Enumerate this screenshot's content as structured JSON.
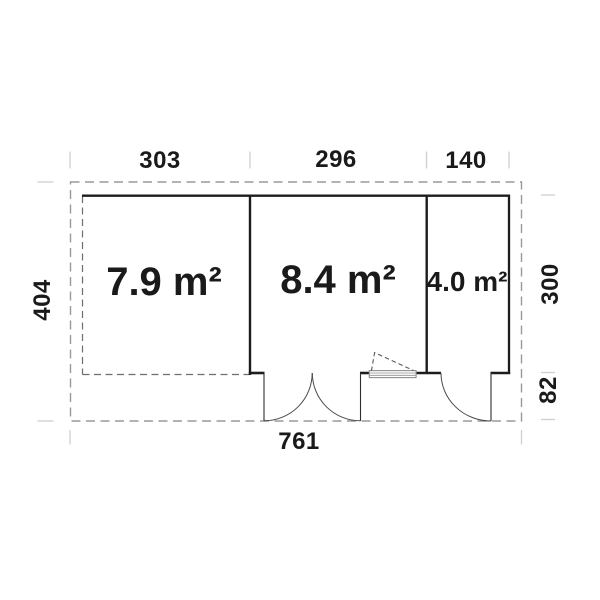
{
  "diagram": {
    "type": "floor-plan",
    "rooms": [
      {
        "name": "terrace",
        "area_label": "7.9 m²"
      },
      {
        "name": "main-room",
        "area_label": "8.4 m²"
      },
      {
        "name": "side-room",
        "area_label": "4.0 m²"
      }
    ],
    "dimensions": {
      "top_left_width": "303",
      "top_middle_width": "296",
      "top_right_width": "140",
      "left_depth": "404",
      "right_depth": "300",
      "right_front_depth": "82",
      "total_width": "761"
    },
    "colors": {
      "wall": "#1c1c1c",
      "overhang_dash": "#9a9a9a",
      "terrace_dash": "#6e6e6e",
      "tick": "#cfcfcf",
      "door_arc": "#4a4a4a",
      "window": "#8f8f8f",
      "text": "#1a1a1a",
      "background": "#ffffff"
    }
  }
}
